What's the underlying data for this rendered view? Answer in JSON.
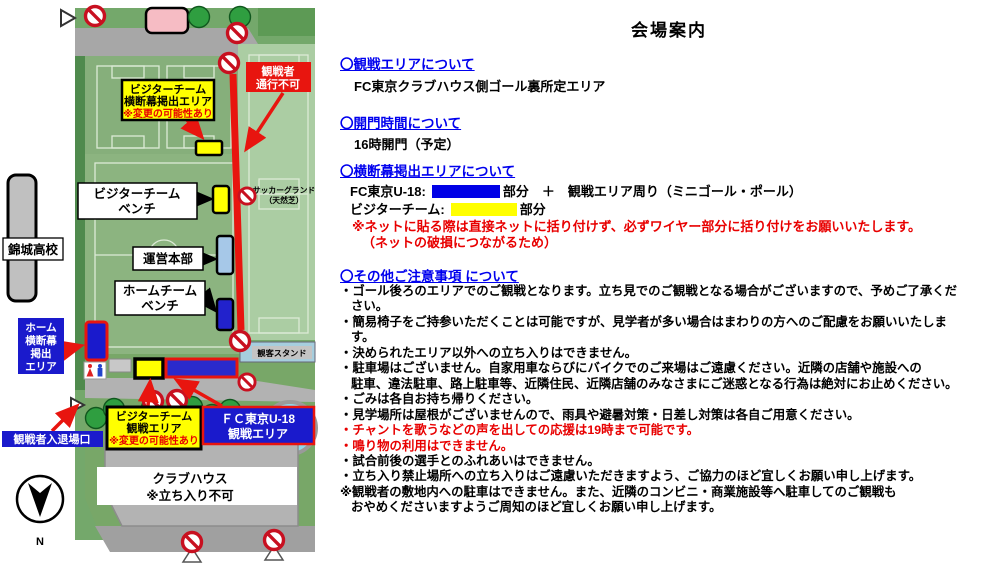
{
  "title": "会場案内",
  "sections": {
    "viewing_area": {
      "heading": "〇観戦エリアについて",
      "body": "FC東京クラブハウス側ゴール裏所定エリア"
    },
    "gate_time": {
      "heading": "〇開門時間について",
      "body": "16時開門（予定）"
    },
    "banner": {
      "heading": "〇横断幕掲出エリアについて",
      "fc_label": "FC東京U-18:",
      "fc_suffix": "部分　＋　観戦エリア周り（ミニゴール・ポール）",
      "visitor_label": "ビジターチーム:",
      "visitor_suffix": "部分",
      "note1": "※ネットに貼る際は直接ネットに括り付けず、必ずワイヤー部分に括り付けをお願いいたします。",
      "note2": "（ネットの破損につながるため）"
    },
    "other_notes": {
      "heading": "〇その他ご注意事項 について",
      "lines": [
        {
          "text": "・ゴール後ろのエリアでのご観戦となります。立ち見でのご観戦となる場合がございますので、予めご了承くだ"
        },
        {
          "text": "さい。"
        },
        {
          "text": "・簡易椅子をご持参いただくことは可能ですが、見学者が多い場合はまわりの方へのご配慮をお願いいたしま"
        },
        {
          "text": "す。"
        },
        {
          "text": "・決められたエリア以外への立ち入りはできません。"
        },
        {
          "text": "・駐車場はございません。自家用車ならびにバイクでのご来場はご遠慮ください。近隣の店舗や施設への"
        },
        {
          "text": "駐車、違法駐車、路上駐車等、近隣住民、近隣店舗のみなさまにご迷惑となる行為は絶対にお止めください。"
        },
        {
          "text": "・ごみは各自お持ち帰りください。"
        },
        {
          "text": "・見学場所は屋根がございませんので、雨具や避暑対策・日差し対策は各自ご用意ください。"
        },
        {
          "text": "・チャントを歌うなどの声を出しての応援は19時まで可能です。"
        },
        {
          "text": "・鳴り物の利用はできません。"
        },
        {
          "text": "・試合前後の選手とのふれあいはできません。"
        },
        {
          "text": "・立ち入り禁止場所への立ち入りはご遠慮いただきますよう、ご協力のほど宜しくお願い申し上げます。"
        },
        {
          "text": "※観戦者の敷地内への駐車はできません。また、近隣のコンビニ・商業施設等へ駐車してのご観戦も"
        },
        {
          "text": "おやめくださいますようご周知のほど宜しくお願い申し上げます。"
        }
      ]
    }
  },
  "map": {
    "spectator_no_pass": [
      "観戦者",
      "通行不可"
    ],
    "visitor_banner_area": [
      "ビジターチーム",
      "横断幕掲出エリア",
      "※変更の可能性あり"
    ],
    "visitor_bench": [
      "ビジターチーム",
      "ベンチ"
    ],
    "ops_hq": "運営本部",
    "home_bench": [
      "ホームチーム",
      "ベンチ"
    ],
    "kinjo_school": "錦城高校",
    "soccer_ground": [
      "サッカーグランド",
      "（天然芝）"
    ],
    "home_banner_area": [
      "ホーム",
      "横断幕",
      "掲出",
      "エリア"
    ],
    "stand": "観客スタンド",
    "entrance": "観戦者入退場口",
    "visitor_viewing": [
      "ビジターチーム",
      "観戦エリア",
      "※変更の可能性あり"
    ],
    "u18_viewing": [
      "ＦＣ東京U-18",
      "観戦エリア"
    ],
    "clubhouse": [
      "クラブハウス",
      "※立ち入り不可"
    ],
    "compass_n": "N"
  },
  "colors": {
    "heading_blue": "#0000ee",
    "alert_red": "#e80000",
    "map_blue": "#1a1acc",
    "map_yellow": "#ffff00",
    "path_red": "#e8150f",
    "field_green": "#8cb480",
    "stand_blue": "#a6cede"
  }
}
